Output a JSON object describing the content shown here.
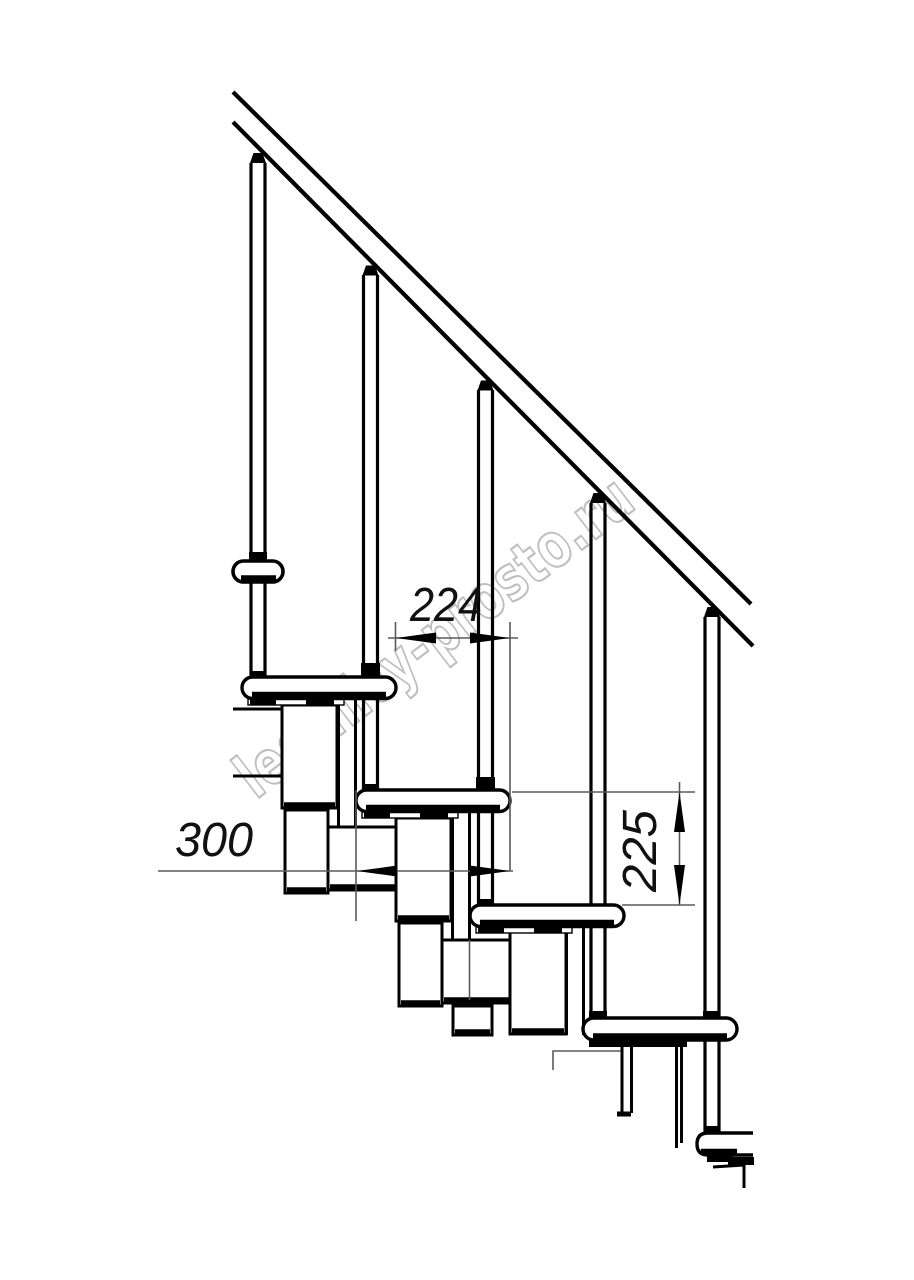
{
  "drawing": {
    "kind": "staircase-side-elevation",
    "dimensions": {
      "run": {
        "value": "224",
        "orientation": "horizontal"
      },
      "depth": {
        "value": "300",
        "orientation": "horizontal"
      },
      "rise": {
        "value": "225",
        "orientation": "vertical"
      }
    },
    "watermark": {
      "text": "lestnicy-prosto.ru"
    },
    "colors": {
      "line": "#000000",
      "dim_line": "#5a5a5a",
      "text": "#111111",
      "watermark": "#b4b4b4",
      "background": "#ffffff"
    }
  }
}
